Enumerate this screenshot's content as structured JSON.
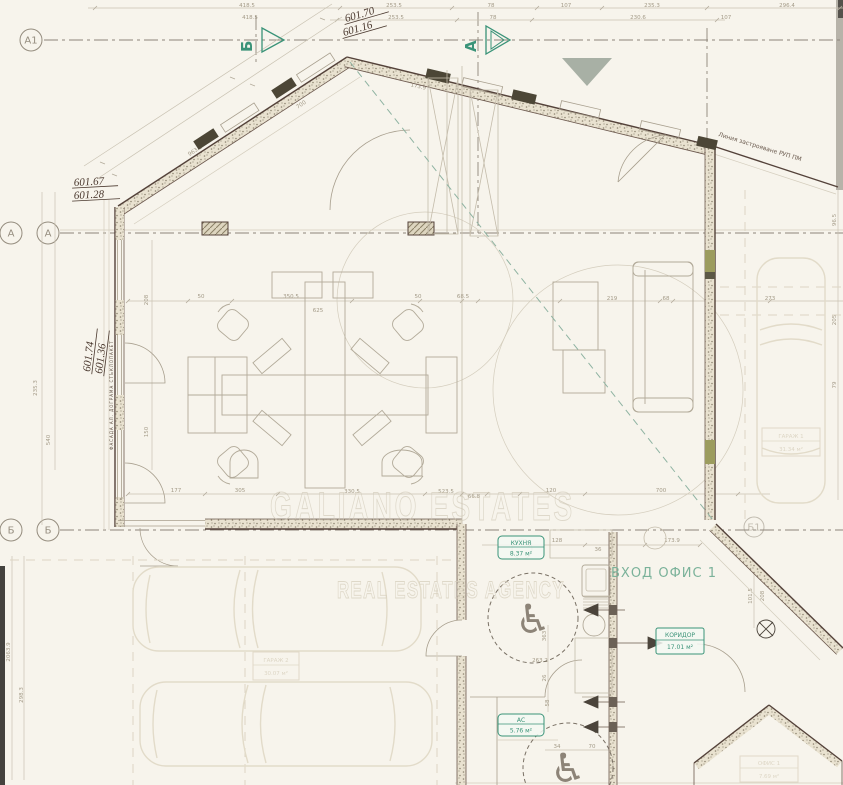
{
  "plan": {
    "watermark": {
      "line1": "GALIANO ESTATES",
      "line2": "REAL ESTATES AGENCY"
    },
    "elevations": {
      "ridge_top": "601.70",
      "ridge_bottom": "601.16",
      "left_top": "601.67",
      "left_bottom": "601.28",
      "west_top": "601.74",
      "west_bottom": "601.36"
    },
    "grid": {
      "a1": "А1",
      "a_outer": "А",
      "a_inner": "А",
      "b_outer": "Б",
      "b_inner": "Б",
      "b1": "Б1"
    },
    "sections": {
      "b": "Б",
      "a": "А"
    },
    "note_line": "Линия застрояване РУП ПМ",
    "micro_note": "ФАСАДА АЛ. ДОГРАМА СТЪКЛОПАКЕТ",
    "rooms": {
      "entrance": "ВХОД ОФИС 1",
      "kitchen": {
        "name": "КУХНЯ",
        "area": "8.37 м²"
      },
      "corridor": {
        "name": "КОРИДОР",
        "area": "17.01 м²"
      },
      "wc": {
        "name": "АС",
        "area": "5.76 м²"
      },
      "garage_right": {
        "name": "ГАРАЖ 1",
        "area": "31.34 м²"
      },
      "garage_left": {
        "name": "ГАРАЖ 2",
        "area": "30.07 м²"
      },
      "office_small": {
        "name": "ОФИС 1",
        "area": "7.69 м²"
      }
    },
    "colors": {
      "paper": "#f7f4ec",
      "wall": "#54423a",
      "green": "#3a9378",
      "soft_green": "#7bb29a",
      "stipple": "#8f8672",
      "olive": "#9c9c5e",
      "faint": "#e2dbc9",
      "dim_text": "#a39a87",
      "watermark": "#cfc8b6"
    },
    "dimensions": [
      {
        "t": "418.5",
        "x": 247,
        "y": 7,
        "r": 0
      },
      {
        "t": "253.5",
        "x": 394,
        "y": 7,
        "r": 0
      },
      {
        "t": "78",
        "x": 491,
        "y": 7,
        "r": 0
      },
      {
        "t": "107",
        "x": 566,
        "y": 7,
        "r": 0
      },
      {
        "t": "235.3",
        "x": 652,
        "y": 7,
        "r": 0
      },
      {
        "t": "296.4",
        "x": 787,
        "y": 7,
        "r": 0
      },
      {
        "t": "418.5",
        "x": 250,
        "y": 19,
        "r": 0
      },
      {
        "t": "253.5",
        "x": 396,
        "y": 19,
        "r": 0
      },
      {
        "t": "78",
        "x": 493,
        "y": 19,
        "r": 0
      },
      {
        "t": "230.6",
        "x": 638,
        "y": 19,
        "r": 0
      },
      {
        "t": "107",
        "x": 726,
        "y": 19,
        "r": 0
      },
      {
        "t": "963.3",
        "x": 196,
        "y": 152,
        "r": -33
      },
      {
        "t": "700",
        "x": 302,
        "y": 106,
        "r": -33
      },
      {
        "t": "523.5",
        "x": 160,
        "y": 190,
        "r": -33
      },
      {
        "t": "173.9",
        "x": 418,
        "y": 88,
        "r": 13
      },
      {
        "t": "235.3",
        "x": 37,
        "y": 388,
        "r": -90
      },
      {
        "t": "540",
        "x": 50,
        "y": 440,
        "r": -90
      },
      {
        "t": "208",
        "x": 148,
        "y": 300,
        "r": -90
      },
      {
        "t": "150",
        "x": 148,
        "y": 432,
        "r": -90
      },
      {
        "t": "2063.9",
        "x": 10,
        "y": 652,
        "r": -90
      },
      {
        "t": "298.3",
        "x": 23,
        "y": 695,
        "r": -90
      },
      {
        "t": "50",
        "x": 201,
        "y": 298,
        "r": 0
      },
      {
        "t": "350.5",
        "x": 291,
        "y": 298,
        "r": 0
      },
      {
        "t": "625",
        "x": 318,
        "y": 312,
        "r": 0
      },
      {
        "t": "50",
        "x": 418,
        "y": 298,
        "r": 0
      },
      {
        "t": "68.5",
        "x": 463,
        "y": 298,
        "r": 0
      },
      {
        "t": "219",
        "x": 612,
        "y": 300,
        "r": 0
      },
      {
        "t": "68",
        "x": 666,
        "y": 300,
        "r": 0
      },
      {
        "t": "273",
        "x": 770,
        "y": 300,
        "r": 0
      },
      {
        "t": "96.5",
        "x": 836,
        "y": 220,
        "r": -90
      },
      {
        "t": "205",
        "x": 836,
        "y": 320,
        "r": -90
      },
      {
        "t": "79",
        "x": 836,
        "y": 385,
        "r": -90
      },
      {
        "t": "177",
        "x": 176,
        "y": 492,
        "r": 0
      },
      {
        "t": "305",
        "x": 240,
        "y": 492,
        "r": 0
      },
      {
        "t": "330.5",
        "x": 352,
        "y": 493,
        "r": 0
      },
      {
        "t": "523.5",
        "x": 446,
        "y": 493,
        "r": 0
      },
      {
        "t": "66.8",
        "x": 474,
        "y": 498,
        "r": 0
      },
      {
        "t": "120",
        "x": 551,
        "y": 492,
        "r": 0
      },
      {
        "t": "700",
        "x": 661,
        "y": 492,
        "r": 0
      },
      {
        "t": "128",
        "x": 557,
        "y": 542,
        "r": 0
      },
      {
        "t": "36",
        "x": 598,
        "y": 551,
        "r": 0
      },
      {
        "t": "173.9",
        "x": 672,
        "y": 542,
        "r": 0
      },
      {
        "t": "101.5",
        "x": 752,
        "y": 596,
        "r": -90
      },
      {
        "t": "208",
        "x": 764,
        "y": 596,
        "r": -90
      },
      {
        "t": "363",
        "x": 546,
        "y": 636,
        "r": -90
      },
      {
        "t": "26",
        "x": 546,
        "y": 678,
        "r": -90
      },
      {
        "t": "58",
        "x": 549,
        "y": 703,
        "r": -90
      },
      {
        "t": "263.2",
        "x": 540,
        "y": 662,
        "r": 0
      },
      {
        "t": "34",
        "x": 557,
        "y": 748,
        "r": 0
      },
      {
        "t": "70",
        "x": 592,
        "y": 748,
        "r": 0
      }
    ]
  }
}
